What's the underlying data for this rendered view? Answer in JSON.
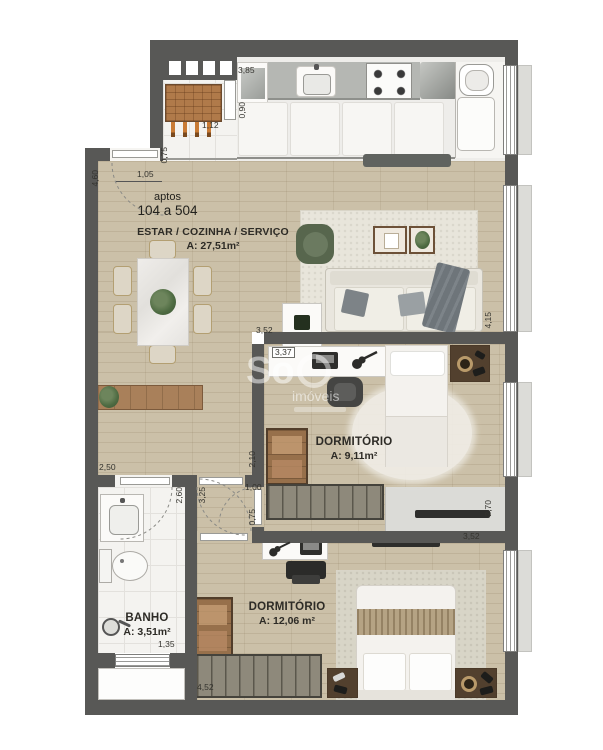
{
  "unit": {
    "line1": "aptos",
    "line2": "104 a 504"
  },
  "rooms": {
    "living": {
      "name": "ESTAR / COZINHA / SERVIÇO",
      "area": "A: 27,51m²"
    },
    "dorm1": {
      "name": "DORMITÓRIO",
      "area": "A: 9,11m²"
    },
    "dorm2": {
      "name": "DORMITÓRIO",
      "area": "A: 12,06 m²"
    },
    "bath": {
      "name": "BANHO",
      "area": "A: 3,51m²"
    }
  },
  "dims": {
    "kitchen_width": "3,85",
    "counter_depth": "0,90",
    "grill_width": "1,12",
    "entry_wall": "0,75",
    "living_left": "4,60",
    "entry_door": "1,05",
    "living_right": "4,15",
    "dorm1_width": "3,52",
    "desk1_width": "3,37",
    "corridor_top": "2,50",
    "bath_length": "2,60",
    "hall_length": "3,25",
    "dorm1_wall": "2,10",
    "dorm1_door": "1,00",
    "dorm1_door_w": "0,75",
    "dorm2_right": "2,70",
    "dorm2_width_top": "3,52",
    "bath_width": "1,35",
    "dorm2_width": "4,52"
  },
  "watermark": {
    "brand": "So",
    "sub": "imóveis"
  },
  "palette": {
    "wall": "#585856",
    "wood_floor": "#cbc0a8",
    "tile_floor": "#f4f3f0",
    "counter": "#b5b7b3",
    "wood_furniture": "#a9805a",
    "armchair_green": "#5c6b51"
  }
}
